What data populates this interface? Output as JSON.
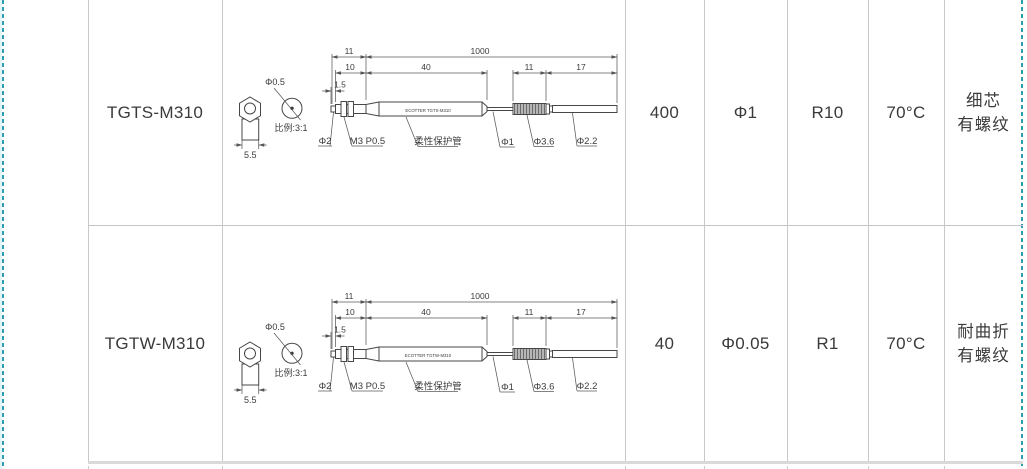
{
  "page": {
    "background": "#ffffff",
    "grid_color": "#c8c8c8",
    "guide_color": "#2f9db0",
    "ink_color": "#3a3a3a"
  },
  "table": {
    "rows": [
      {
        "model": "TGTS-M310",
        "tube_label": "ECOTTER TGTS-M310",
        "v1": "400",
        "v2": "Φ1",
        "v3": "R10",
        "v4": "70°C",
        "note1": "细芯",
        "note2": "有螺纹"
      },
      {
        "model": "TGTW-M310",
        "tube_label": "ECOTTER TGTW-M310",
        "v1": "40",
        "v2": "Φ0.05",
        "v3": "R1",
        "v4": "70°C",
        "note1": "耐曲折",
        "note2": "有螺纹"
      }
    ],
    "drawing": {
      "dims": {
        "d11": "11",
        "d1000": "1000",
        "d10": "10",
        "d40": "40",
        "d11b": "11",
        "d17": "17",
        "d15": "1.5",
        "d55": "5.5"
      },
      "labels": {
        "phi05": "Φ0.5",
        "scale": "比例:3:1",
        "phi2": "Φ2",
        "thread": "M3 P0.5",
        "tube": "柔性保护管",
        "phi1": "Φ1",
        "phi36": "Φ3.6",
        "phi22": "Φ2.2"
      }
    }
  }
}
